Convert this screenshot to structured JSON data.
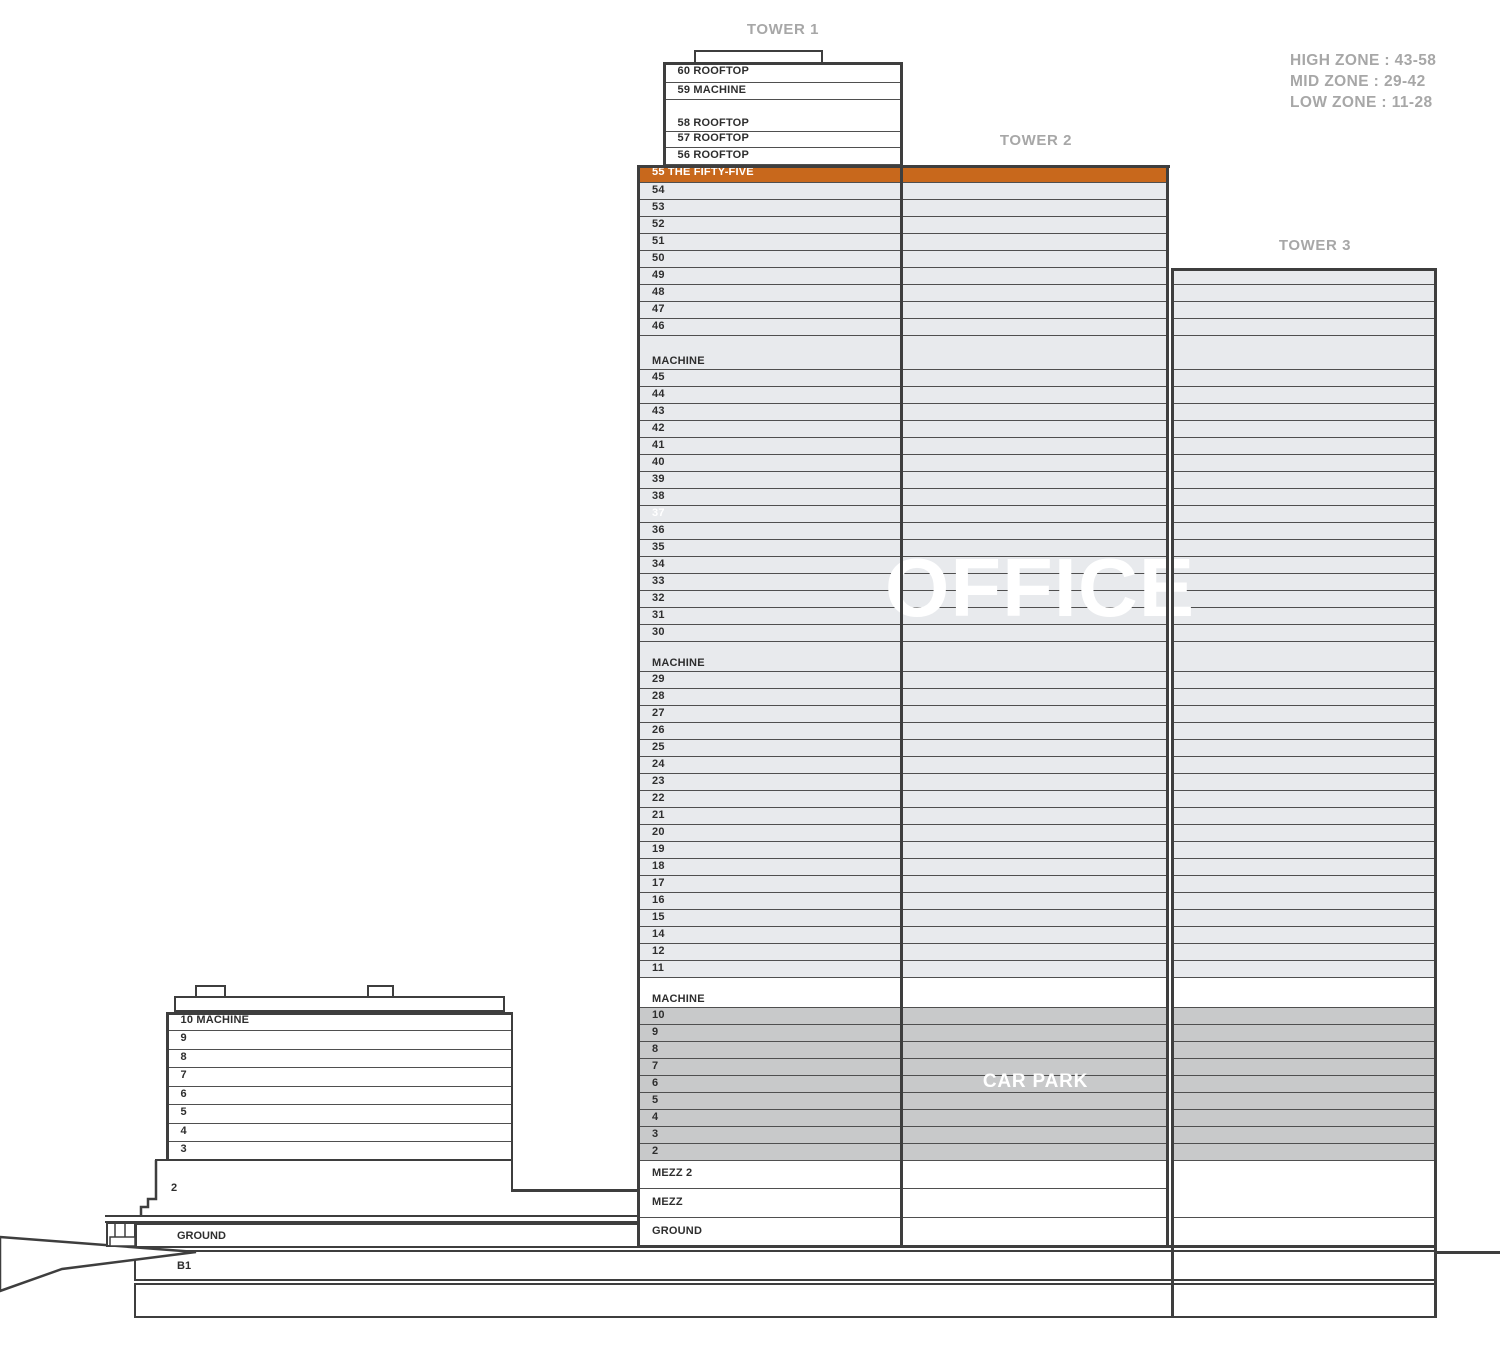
{
  "labels": {
    "tower1": "TOWER 1",
    "tower2": "TOWER 2",
    "tower3": "TOWER 3"
  },
  "zones": {
    "high": "HIGH ZONE : 43-58",
    "mid": "MID ZONE : 29-42",
    "low": "LOW ZONE : 11-28"
  },
  "watermarks": {
    "office": "OFFICE",
    "carpark": "CAR PARK"
  },
  "colors": {
    "accent_orange": "#C8681C",
    "floor_light": "#E8EAED",
    "floor_dark": "#C8C9CA",
    "floor_white": "#FFFFFF",
    "wall_dark": "#3E3E3E",
    "divider": "#4F4F4F",
    "label_gray": "#A7A7A7",
    "floor_text": "#2E2E2E",
    "white_text": "#FFFFFF"
  },
  "tower1_upper": [
    {
      "label": "60 ROOFTOP",
      "h": 21
    },
    {
      "label": "59 MACHINE",
      "h": 17
    },
    {
      "label": "58 ROOFTOP",
      "h": 32,
      "valign": "bottom"
    },
    {
      "label": "57 ROOFTOP",
      "h": 16
    },
    {
      "label": "56 ROOFTOP",
      "h": 17
    }
  ],
  "tower_bands": [
    {
      "label": "55 THE FIFTY-FIVE",
      "h": 18,
      "fill": "orange",
      "text_color": "white"
    },
    {
      "label": "54",
      "h": 17,
      "fill": "light"
    },
    {
      "label": "53",
      "h": 17,
      "fill": "light"
    },
    {
      "label": "52",
      "h": 17,
      "fill": "light"
    },
    {
      "label": "51",
      "h": 17,
      "fill": "light"
    },
    {
      "label": "50",
      "h": 17,
      "fill": "light"
    },
    {
      "label": "49",
      "h": 17,
      "fill": "light"
    },
    {
      "label": "48",
      "h": 17,
      "fill": "light"
    },
    {
      "label": "47",
      "h": 17,
      "fill": "light"
    },
    {
      "label": "46",
      "h": 17,
      "fill": "light"
    },
    {
      "label": "MACHINE",
      "h": 34,
      "fill": "light",
      "valign": "bottom"
    },
    {
      "label": "45",
      "h": 17,
      "fill": "light"
    },
    {
      "label": "44",
      "h": 17,
      "fill": "light"
    },
    {
      "label": "43",
      "h": 17,
      "fill": "light"
    },
    {
      "label": "42",
      "h": 17,
      "fill": "light"
    },
    {
      "label": "41",
      "h": 17,
      "fill": "light"
    },
    {
      "label": "40",
      "h": 17,
      "fill": "light"
    },
    {
      "label": "39",
      "h": 17,
      "fill": "light"
    },
    {
      "label": "38",
      "h": 17,
      "fill": "light"
    },
    {
      "label": "37",
      "h": 17,
      "fill": "light",
      "text_color": "white"
    },
    {
      "label": "36",
      "h": 17,
      "fill": "light"
    },
    {
      "label": "35",
      "h": 17,
      "fill": "light"
    },
    {
      "label": "34",
      "h": 17,
      "fill": "light"
    },
    {
      "label": "33",
      "h": 17,
      "fill": "light"
    },
    {
      "label": "32",
      "h": 17,
      "fill": "light"
    },
    {
      "label": "31",
      "h": 17,
      "fill": "light"
    },
    {
      "label": "30",
      "h": 17,
      "fill": "light"
    },
    {
      "label": "MACHINE",
      "h": 30,
      "fill": "light",
      "valign": "bottom"
    },
    {
      "label": "29",
      "h": 17,
      "fill": "light"
    },
    {
      "label": "28",
      "h": 17,
      "fill": "light"
    },
    {
      "label": "27",
      "h": 17,
      "fill": "light"
    },
    {
      "label": "26",
      "h": 17,
      "fill": "light"
    },
    {
      "label": "25",
      "h": 17,
      "fill": "light"
    },
    {
      "label": "24",
      "h": 17,
      "fill": "light"
    },
    {
      "label": "23",
      "h": 17,
      "fill": "light"
    },
    {
      "label": "22",
      "h": 17,
      "fill": "light"
    },
    {
      "label": "21",
      "h": 17,
      "fill": "light"
    },
    {
      "label": "20",
      "h": 17,
      "fill": "light"
    },
    {
      "label": "19",
      "h": 17,
      "fill": "light"
    },
    {
      "label": "18",
      "h": 17,
      "fill": "light"
    },
    {
      "label": "17",
      "h": 17,
      "fill": "light"
    },
    {
      "label": "16",
      "h": 17,
      "fill": "light"
    },
    {
      "label": "15",
      "h": 17,
      "fill": "light"
    },
    {
      "label": "14",
      "h": 17,
      "fill": "light"
    },
    {
      "label": "12",
      "h": 17,
      "fill": "light"
    },
    {
      "label": "11",
      "h": 17,
      "fill": "light"
    },
    {
      "label": "MACHINE",
      "h": 30,
      "fill": "white",
      "valign": "bottom"
    },
    {
      "label": "10",
      "h": 17,
      "fill": "dark"
    },
    {
      "label": "9",
      "h": 17,
      "fill": "dark"
    },
    {
      "label": "8",
      "h": 17,
      "fill": "dark"
    },
    {
      "label": "7",
      "h": 17,
      "fill": "dark"
    },
    {
      "label": "6",
      "h": 17,
      "fill": "dark"
    },
    {
      "label": "5",
      "h": 17,
      "fill": "dark"
    },
    {
      "label": "4",
      "h": 17,
      "fill": "dark"
    },
    {
      "label": "3",
      "h": 17,
      "fill": "dark"
    },
    {
      "label": "2",
      "h": 17,
      "fill": "dark"
    },
    {
      "label": "MEZZ 2",
      "h": 28,
      "fill": "white"
    },
    {
      "label": "MEZZ",
      "h": 29,
      "fill": "white"
    },
    {
      "label": "GROUND",
      "h": 30,
      "fill": "white"
    }
  ],
  "tower3_start": "49",
  "podium_floors": [
    "10 MACHINE",
    "9",
    "8",
    "7",
    "6",
    "5",
    "4",
    "3"
  ],
  "site": {
    "floor2": "2",
    "ground": "GROUND",
    "b1": "B1"
  }
}
